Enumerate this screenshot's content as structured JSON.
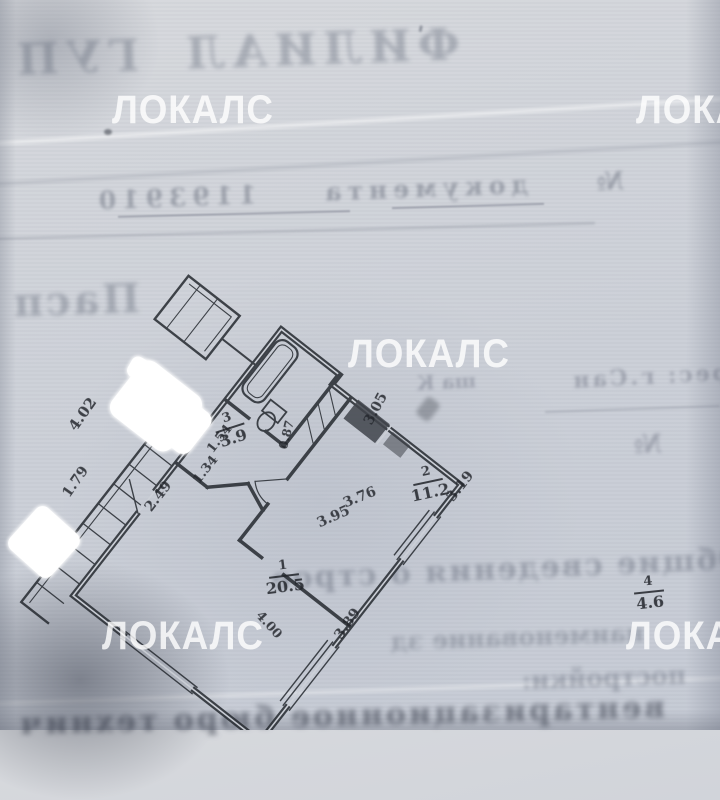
{
  "document": {
    "watermark": {
      "text": "ЛОКАЛС",
      "color": "rgba(255,255,255,0.8)"
    },
    "bleed_through_mirrored": {
      "title_fragment": "ФИЛИАЛ ГУП ГУЧЬ",
      "doc_number_line": "№ документа 1193910",
      "passport_fragment": "Пасп",
      "address_fragment_right": "рес: г.Сан",
      "address_fragment_small": "ша К",
      "number_sign": "№",
      "summary_line": "Общие сведения о строе",
      "name_line": "наименование зд",
      "building_line": "постройки:",
      "bottom_illegible": "вентаризационное бюро технич",
      "tick_mark": "'"
    },
    "floor_plan": {
      "rooms": [
        {
          "number": "1",
          "area": "20.5"
        },
        {
          "number": "2",
          "area": "11.2"
        },
        {
          "number": "3",
          "area": "3.9"
        },
        {
          "number": "4",
          "area": "4.6"
        }
      ],
      "dimensions": [
        "4.02",
        "1.79",
        "2.49",
        "1.34",
        "1.54",
        "0.87",
        "3.05",
        "3.76",
        "3.95",
        "3.19",
        "3.89",
        "4.00"
      ],
      "wall_color": "#262a30"
    }
  }
}
